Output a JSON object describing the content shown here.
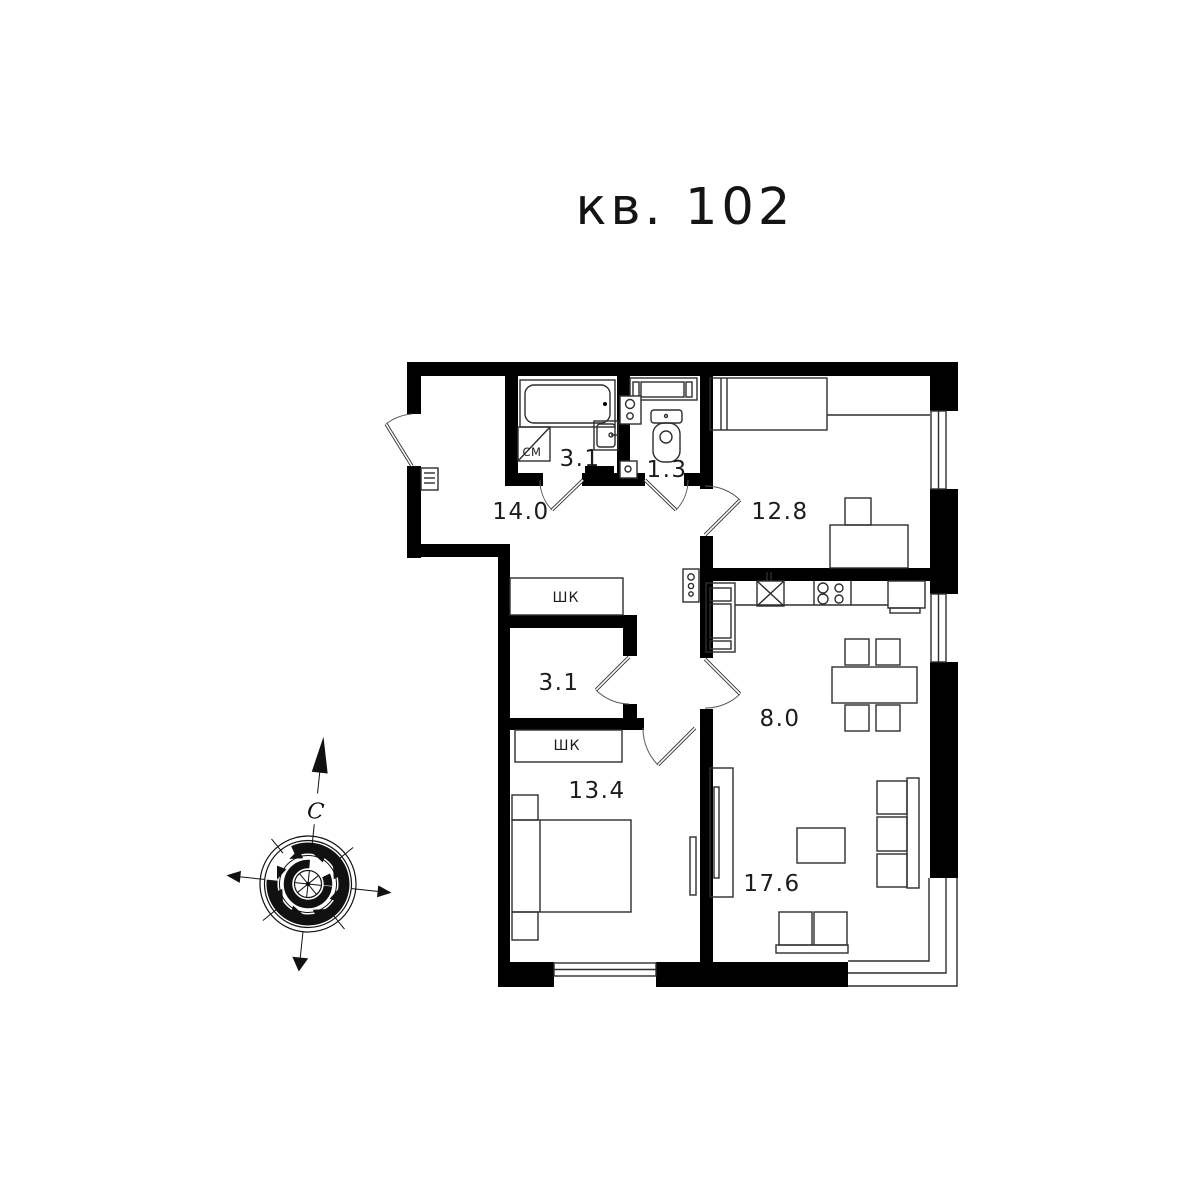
{
  "title": "кв. 102",
  "rooms": {
    "hallway": "14.0",
    "bathroom": "3.1",
    "wc": "1.3",
    "bedroom2": "12.8",
    "corridor": "3.1",
    "kitchen": "8.0",
    "bedroom1": "13.4",
    "living": "17.6"
  },
  "labels": {
    "closet_upper": "ШК",
    "closet_lower": "ШК",
    "washing_machine": "СМ"
  },
  "compass": {
    "north": "С"
  },
  "colors": {
    "wall": "#000000",
    "line": "#2e2e2e",
    "text": "#1c1c1c",
    "background": "#ffffff"
  }
}
